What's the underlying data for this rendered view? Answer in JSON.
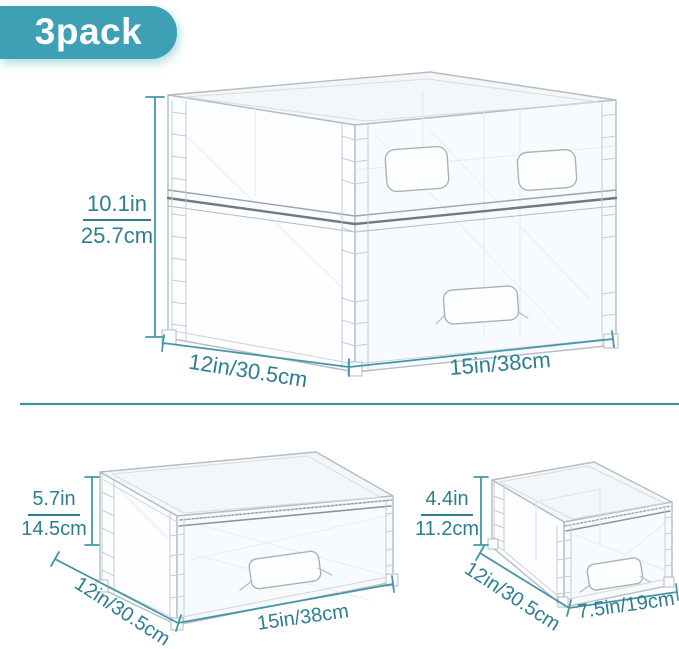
{
  "badge": {
    "label": "3pack"
  },
  "colors": {
    "accent_teal": "#3da0b5",
    "dimension_text": "#2d7e92",
    "dimension_line": "#4497a9"
  },
  "figures": {
    "stacked_unit": {
      "height_in": "10.1in",
      "height_cm": "25.7cm",
      "depth_label": "12in/30.5cm",
      "width_label": "15in/38cm"
    },
    "large_drawer": {
      "height_in": "5.7in",
      "height_cm": "14.5cm",
      "depth_label": "12in/30.5cm",
      "width_label": "15in/38cm"
    },
    "small_drawer": {
      "height_in": "4.4in",
      "height_cm": "11.2cm",
      "depth_label": "12in/30.5cm",
      "width_label": "7.5in/19cm"
    }
  }
}
